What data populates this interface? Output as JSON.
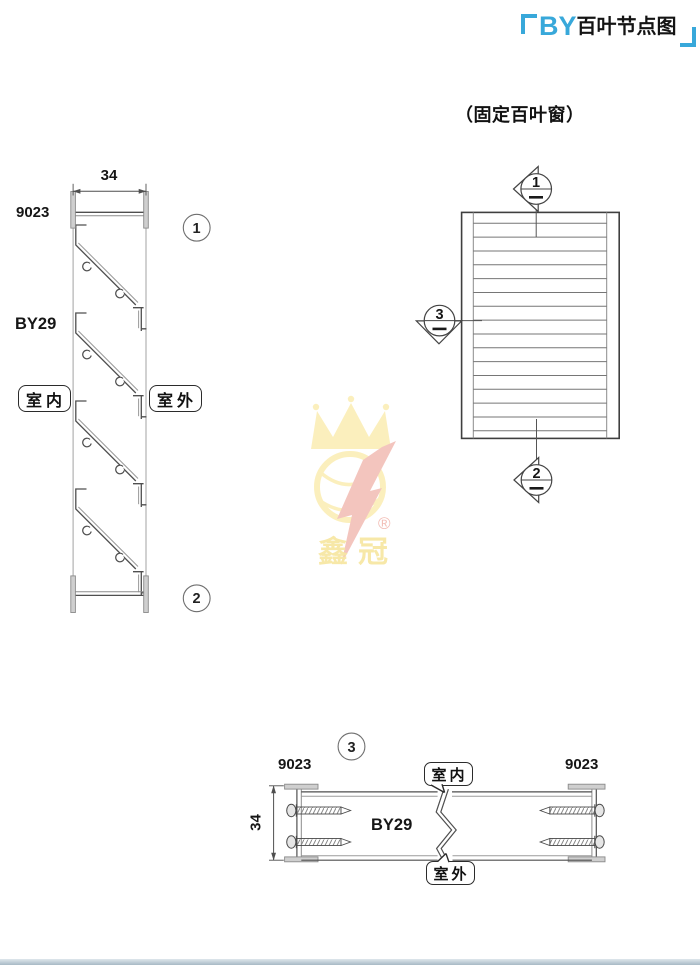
{
  "title": {
    "prefix": "BY",
    "suffix": "百叶节点图"
  },
  "subtitle": {
    "text": "（固定百叶窗）"
  },
  "section": {
    "dim": "34",
    "code": "9023",
    "series": "BY29",
    "indoor": "室内",
    "outdoor": "室外",
    "callout1": "1",
    "callout2": "2"
  },
  "elevation": {
    "m1": "1",
    "m2": "2",
    "m3": "3",
    "louver_count": 16
  },
  "plan": {
    "callout": "3",
    "code_left": "9023",
    "code_right": "9023",
    "dim": "34",
    "series": "BY29",
    "indoor": "室内",
    "outdoor": "室外"
  },
  "watermark": {
    "brand": "鑫冠",
    "reg": "®"
  },
  "colors": {
    "accent_blue": "#38a8da",
    "line_dark": "#4f4f4f",
    "line_light": "#999999",
    "cap_fill": "#cfcfcf",
    "watermark_yellow": "#fbedb2",
    "watermark_pink": "#f2bbb3"
  }
}
